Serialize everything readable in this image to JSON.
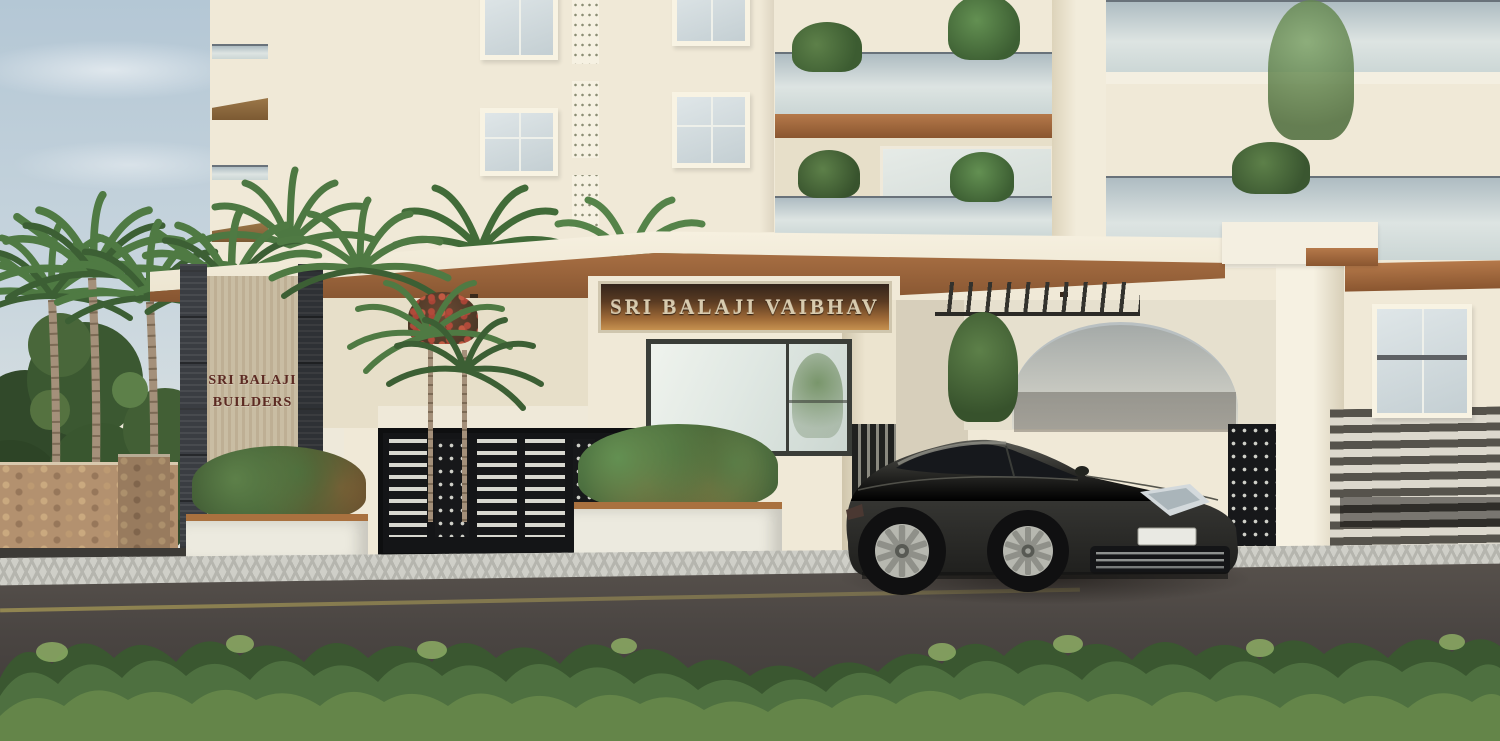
{
  "signs": {
    "project_name": "SRI BALAJI VAIBHAV",
    "builder_name_line1": "SRI BALAJI",
    "builder_name_line2": "BUILDERS"
  },
  "palette": {
    "sky_top": "#b7c9d6",
    "sky_bottom": "#e7eae5",
    "facade_cream": "#f0e9d7",
    "canopy_wood": "#a86f41",
    "sign_panel_bronze": "#9c6836",
    "sign_letters": "#d8cbae",
    "builder_board": "#c9bda3",
    "builder_text": "#5c2a22",
    "stone_cladding_dark": "#3a3d42",
    "rubble_wall_tan": "#b3916f",
    "gate_metal_black": "#17181a",
    "balcony_glass": "#d2dbde",
    "car_body_grey": "#3a3a38",
    "road_asphalt": "#4a4542",
    "road_marking_yellow": "#a89a55",
    "pavement_grey": "#cfcfc8",
    "hedge_green": "#4e7040",
    "palm_green": "#4f7a43"
  },
  "objects": [
    "apartment building facade",
    "entrance canopy",
    "project name sign",
    "builder name pillar sign",
    "metal entrance gates",
    "security cabin corner window",
    "luxury sedan",
    "palm trees",
    "boxwood hedge",
    "rubble stone compound wall",
    "horizontal slat fence",
    "asphalt road"
  ]
}
